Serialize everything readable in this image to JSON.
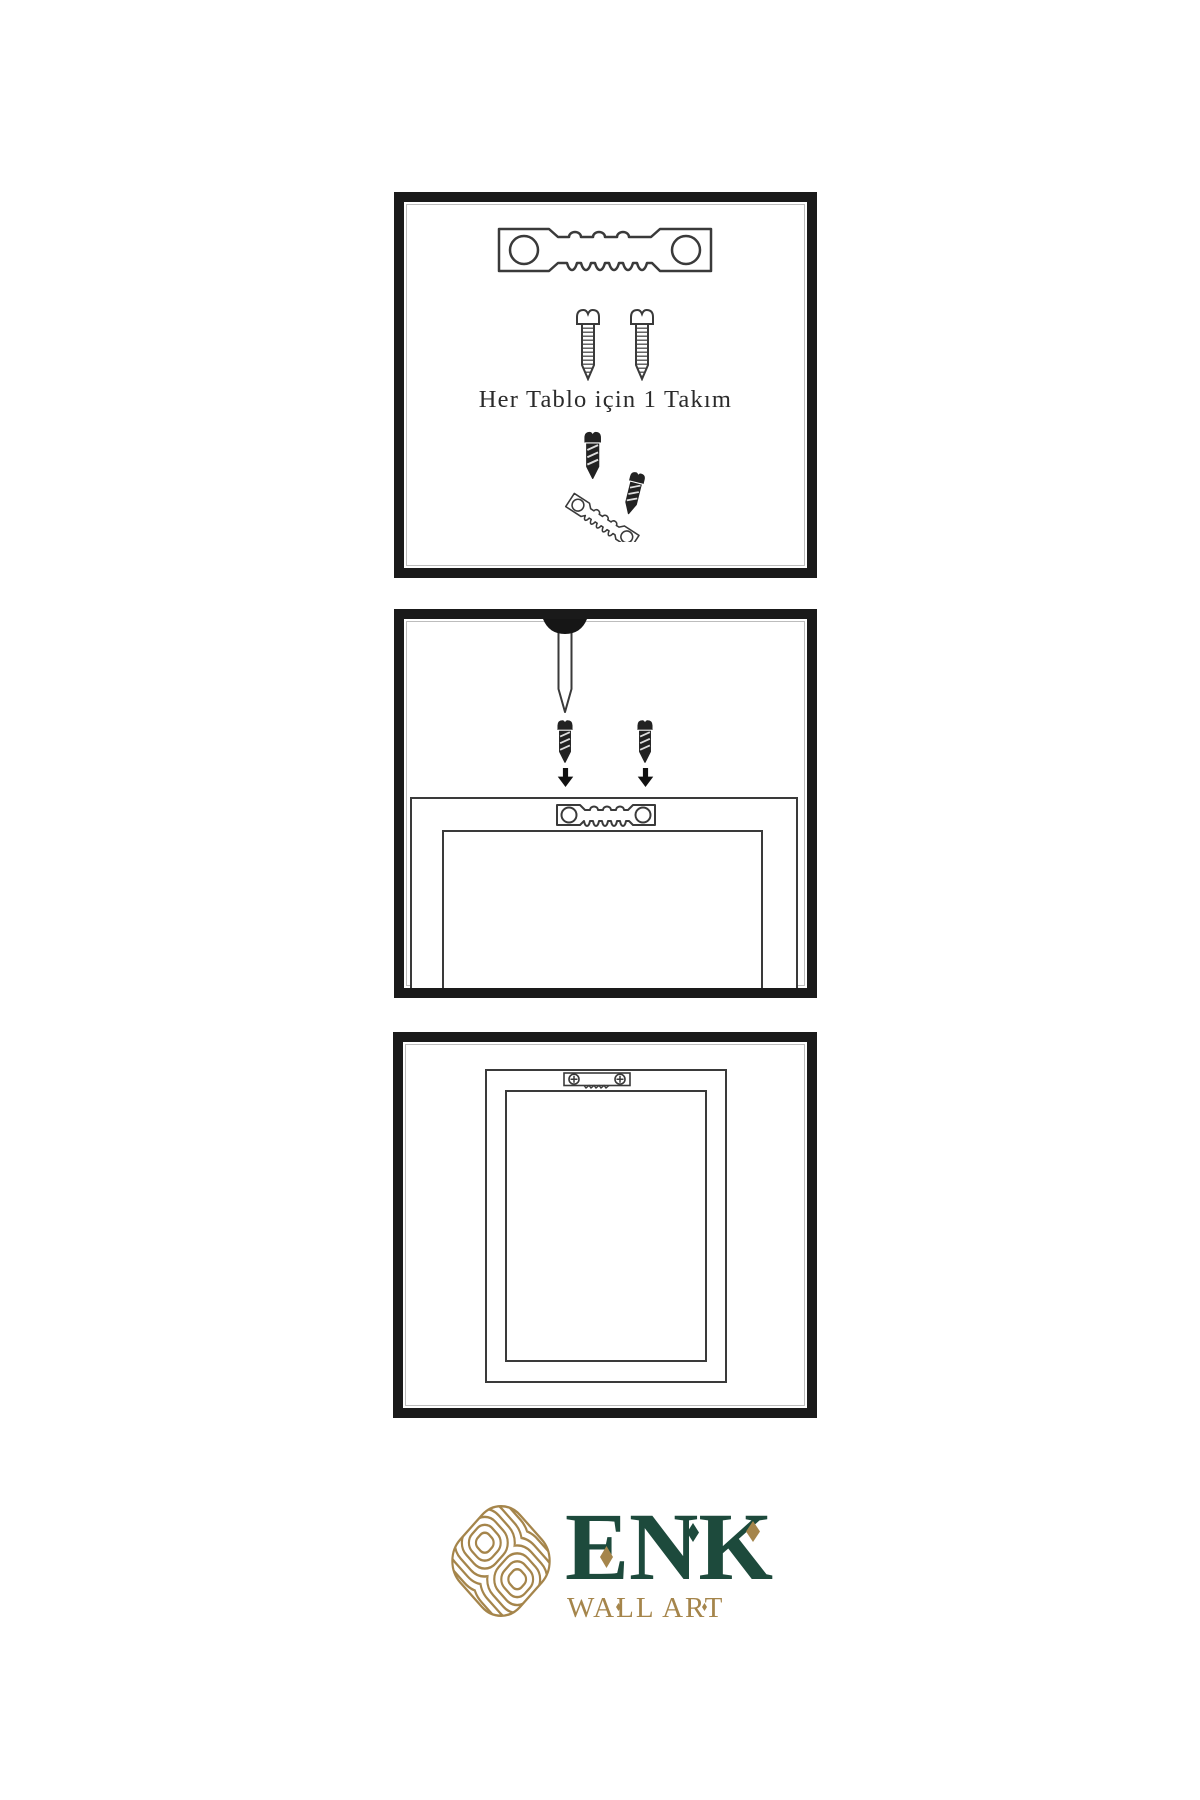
{
  "page": {
    "background": "#ffffff"
  },
  "colors": {
    "ink": "#3a3a3a",
    "panel_border": "#1a1a1a",
    "brand_green": "#1d4a3c",
    "brand_gold": "#a5854b"
  },
  "panel1": {
    "name": "hardware-kit",
    "caption": "Her Tablo için 1 Takım",
    "items": [
      "sawtooth-hanger",
      "screw",
      "screw",
      "screw-and-hanger-angled"
    ]
  },
  "panel2": {
    "name": "installation-step",
    "items": [
      "nail-in-wall",
      "screw-with-down-arrow",
      "screw-with-down-arrow",
      "frame-top-with-sawtooth-hanger"
    ]
  },
  "panel3": {
    "name": "mounted-frame-back",
    "items": [
      "frame-back-with-hanger-screwed"
    ]
  },
  "logo": {
    "brand": "ENK",
    "tagline": "WALL ART"
  }
}
